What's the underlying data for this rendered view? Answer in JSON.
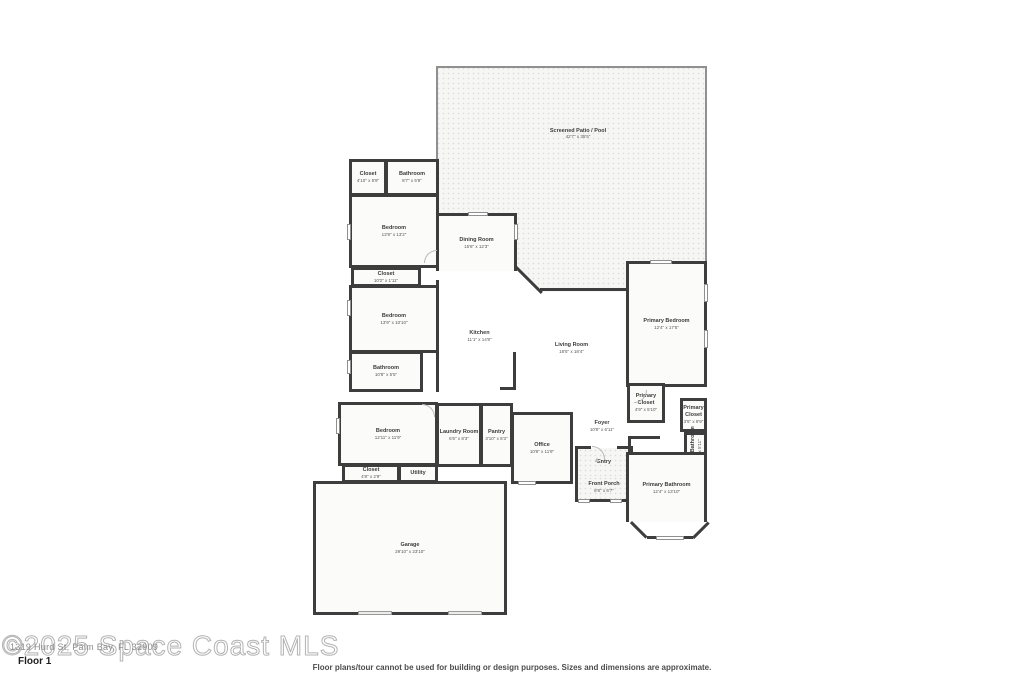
{
  "floor": {
    "label": "Floor 1"
  },
  "watermark": {
    "large": "©2025 Space Coast MLS",
    "small": "1319 Hurd St, Palm Bay, FL 32909"
  },
  "disclaimer": "Floor plans/tour cannot be used for building or design purposes. Sizes and dimensions are approximate.",
  "icons": {
    "entry_marker": "▲"
  },
  "colors": {
    "wall": "#3d3d3d",
    "screen_wall": "#909090",
    "room_fill": "#fbfbfa",
    "texture_fill": "#f6f6f4",
    "label_text": "#3c3c3c",
    "watermark": "#b3b3b3"
  },
  "plan": {
    "patio": {
      "name": "Screened Patio / Pool",
      "dims": "42'7\" x 35'5\""
    },
    "rooms": [
      {
        "id": "closet-top",
        "name": "Closet",
        "dims": "4'10\" x 5'9\"",
        "x": 349,
        "y": 159,
        "w": 38,
        "h": 37,
        "walls": "tlrb"
      },
      {
        "id": "bathroom-top",
        "name": "Bathroom",
        "dims": "8'7\" x 5'9\"",
        "x": 385,
        "y": 159,
        "w": 54,
        "h": 37,
        "walls": "tlrb"
      },
      {
        "id": "bedroom-1",
        "name": "Bedroom",
        "dims": "13'9\" x 13'2\"",
        "x": 349,
        "y": 194,
        "w": 90,
        "h": 74,
        "walls": "tlrb"
      },
      {
        "id": "closet-hall",
        "name": "Closet",
        "dims": "10'2\" x 1'11\"",
        "x": 351,
        "y": 267,
        "w": 70,
        "h": 20,
        "walls": "tlrb"
      },
      {
        "id": "bedroom-2",
        "name": "Bedroom",
        "dims": "13'9\" x 10'10\"",
        "x": 349,
        "y": 285,
        "w": 90,
        "h": 68,
        "walls": "tlrb"
      },
      {
        "id": "bathroom-2",
        "name": "Bathroom",
        "dims": "10'8\" x 5'5\"",
        "x": 349,
        "y": 351,
        "w": 74,
        "h": 41,
        "walls": "tlrb"
      },
      {
        "id": "bedroom-3",
        "name": "Bedroom",
        "dims": "12'11\" x 11'9\"",
        "x": 338,
        "y": 402,
        "w": 100,
        "h": 64,
        "walls": "tlrb"
      },
      {
        "id": "closet-bottom",
        "name": "Closet",
        "dims": "4'8\" x 2'9\"",
        "x": 342,
        "y": 464,
        "w": 58,
        "h": 19,
        "walls": "tlrb"
      },
      {
        "id": "utility",
        "name": "Utility",
        "dims": "",
        "x": 398,
        "y": 464,
        "w": 40,
        "h": 19,
        "walls": "tlrb"
      },
      {
        "id": "laundry-room",
        "name": "Laundry Room",
        "dims": "6'6\" x 8'3\"",
        "x": 436,
        "y": 403,
        "w": 46,
        "h": 64,
        "walls": "tlrb"
      },
      {
        "id": "pantry",
        "name": "Pantry",
        "dims": "3'10\" x 8'3\"",
        "x": 480,
        "y": 403,
        "w": 33,
        "h": 64,
        "walls": "tlrb"
      },
      {
        "id": "office",
        "name": "Office",
        "dims": "10'8\" x 11'9\"",
        "x": 511,
        "y": 412,
        "w": 62,
        "h": 72,
        "walls": "tlrb"
      },
      {
        "id": "dining-room",
        "name": "Dining Room",
        "dims": "15'6\" x 12'3\"",
        "x": 436,
        "y": 213,
        "w": 81,
        "h": 58,
        "walls": "tlr"
      },
      {
        "id": "kitchen",
        "name": "Kitchen",
        "dims": "11'1\" x 14'8\"",
        "x": 436,
        "y": 280,
        "w": 84,
        "h": 112,
        "walls": "l",
        "open": true
      },
      {
        "id": "living-room",
        "name": "Living Room",
        "dims": "18'5\" x 18'4\"",
        "x": 516,
        "y": 291,
        "w": 111,
        "h": 115,
        "walls": "",
        "open": true
      },
      {
        "id": "foyer",
        "name": "Foyer",
        "dims": "10'8\" x 6'11\"",
        "x": 571,
        "y": 406,
        "w": 62,
        "h": 40,
        "walls": "",
        "open": true
      },
      {
        "id": "entry",
        "name": "Entry",
        "dims": "",
        "x": 575,
        "y": 448,
        "w": 58,
        "h": 28,
        "walls": "lr",
        "texture": true
      },
      {
        "id": "front-porch",
        "name": "Front Porch",
        "dims": "8'8\" x 6'7\"",
        "x": 575,
        "y": 476,
        "w": 58,
        "h": 26,
        "walls": "lrb",
        "texture": true
      },
      {
        "id": "primary-bedroom",
        "name": "Primary Bedroom",
        "dims": "12'4\" x 17'5\"",
        "x": 626,
        "y": 261,
        "w": 81,
        "h": 126,
        "walls": "tlrb"
      },
      {
        "id": "primary-closet-1",
        "name": "Primary Closet",
        "dims": "4'9\" x 5'10\"",
        "x": 627,
        "y": 383,
        "w": 38,
        "h": 40,
        "walls": "tlrb",
        "wrapname": true
      },
      {
        "id": "primary-closet-2",
        "name": "Primary Closet",
        "dims": "3'5\" x 8'9\"",
        "x": 680,
        "y": 398,
        "w": 27,
        "h": 34,
        "walls": "tlrb",
        "wrapname": true
      },
      {
        "id": "primary-bathroom-wc",
        "name": "Primary Bathroom",
        "dims": "2'6\" x 5'11\"",
        "x": 684,
        "y": 432,
        "w": 23,
        "h": 36,
        "walls": "tlrb",
        "vertical": true
      },
      {
        "id": "closet-primary",
        "name": "Closet",
        "dims": "",
        "x": 690,
        "y": 470,
        "w": 17,
        "h": 28,
        "walls": "tlrb",
        "vertical": true
      },
      {
        "id": "primary-bathroom",
        "name": "Primary Bathroom",
        "dims": "12'4\" x 13'10\"",
        "x": 626,
        "y": 452,
        "w": 81,
        "h": 70,
        "walls": "tlr"
      },
      {
        "id": "garage",
        "name": "Garage",
        "dims": "29'10\" x 23'10\"",
        "x": 313,
        "y": 481,
        "w": 194,
        "h": 134,
        "walls": "tlrb"
      }
    ]
  }
}
